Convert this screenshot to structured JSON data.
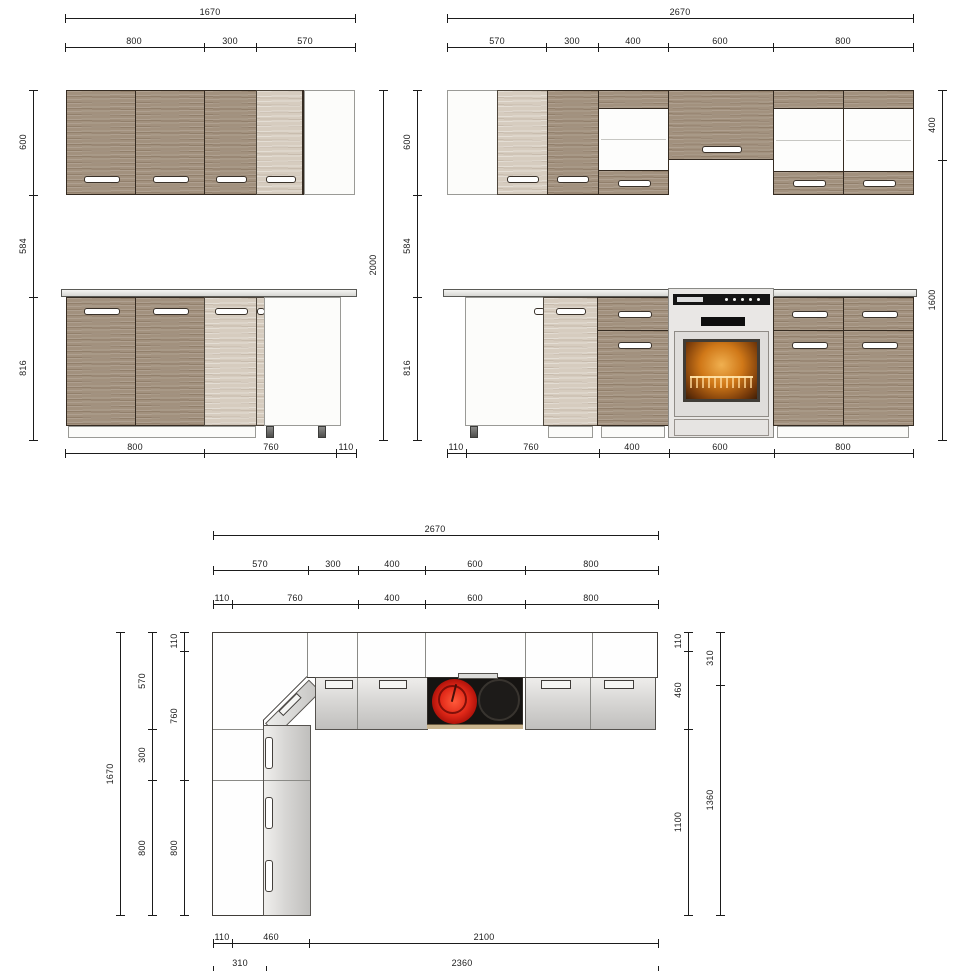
{
  "drawing": {
    "kind": "kitchen cabinet technical drawing",
    "views": [
      "front elevation left run",
      "front elevation right run",
      "plan view"
    ]
  },
  "views": {
    "front_left": {
      "dims": {
        "total_width": "1670",
        "top_segments": [
          "800",
          "300",
          "570"
        ],
        "left_heights": [
          "600",
          "584",
          "816"
        ],
        "total_height": "2000",
        "bottom_segments": [
          "800",
          "760",
          "110"
        ]
      }
    },
    "front_right": {
      "dims": {
        "total_width": "2670",
        "top_segments": [
          "570",
          "300",
          "400",
          "600",
          "800"
        ],
        "left_heights": [
          "600",
          "584",
          "816"
        ],
        "right_heights": [
          "400",
          "1600"
        ],
        "bottom_segments": [
          "110",
          "760",
          "400",
          "600",
          "800"
        ]
      }
    },
    "plan": {
      "dims": {
        "total_width": "2670",
        "top_segments": [
          "570",
          "300",
          "400",
          "600",
          "800"
        ],
        "top_segments_inner": [
          "110",
          "760",
          "400",
          "600",
          "800"
        ],
        "left_total": "1670",
        "left_outer": [
          "570",
          "300",
          "800"
        ],
        "left_inner": [
          "110",
          "760",
          "800"
        ],
        "right_inner": [
          "110",
          "460",
          "1100"
        ],
        "right_outer": [
          "310",
          "1360"
        ],
        "bottom_segments": [
          "110",
          "460",
          "2100"
        ],
        "bottom_segments_outer": [
          "310",
          "2360"
        ]
      }
    }
  },
  "colors": {
    "wood_dark": "#a2917e",
    "wood_light": "#d6ccbf",
    "cabinet_white": "#fcfcfa",
    "counter_gray": "#e2e2de",
    "dimension_line": "#1b1b1b",
    "hob_black": "#161412",
    "burner_active_red": "#e02818",
    "oven_silver": "#e9e7e5",
    "oven_glow_orange": "#d07818"
  }
}
